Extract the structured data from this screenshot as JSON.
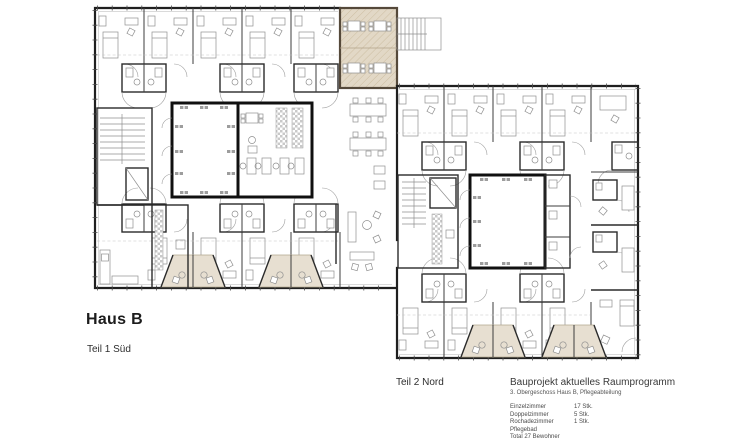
{
  "title_block": {
    "building": "Haus B",
    "part_sued": "Teil 1 Süd",
    "part_nord": "Teil 2 Nord"
  },
  "legend": {
    "title": "Bauprojekt aktuelles Raumprogramm",
    "subtitle": "3. Obergeschoss Haus B, Pflegeabteilung",
    "items": [
      {
        "label": "Einzelzimmer",
        "value": "17 Stk."
      },
      {
        "label": "Doppelzimmer",
        "value": "5 Stk."
      },
      {
        "label": "Rochadezimmer",
        "value": "1 Stk."
      },
      {
        "label": "Pflegebad",
        "value": ""
      },
      {
        "label": "Total 27 Bewohner",
        "value": ""
      }
    ]
  },
  "colors": {
    "wall": "#1f1f1f",
    "loggia_fill": "#e7dfd1",
    "highlight_room_fill": "#e2d8c6",
    "highlight_room_border": "#55493a",
    "background": "#ffffff"
  }
}
